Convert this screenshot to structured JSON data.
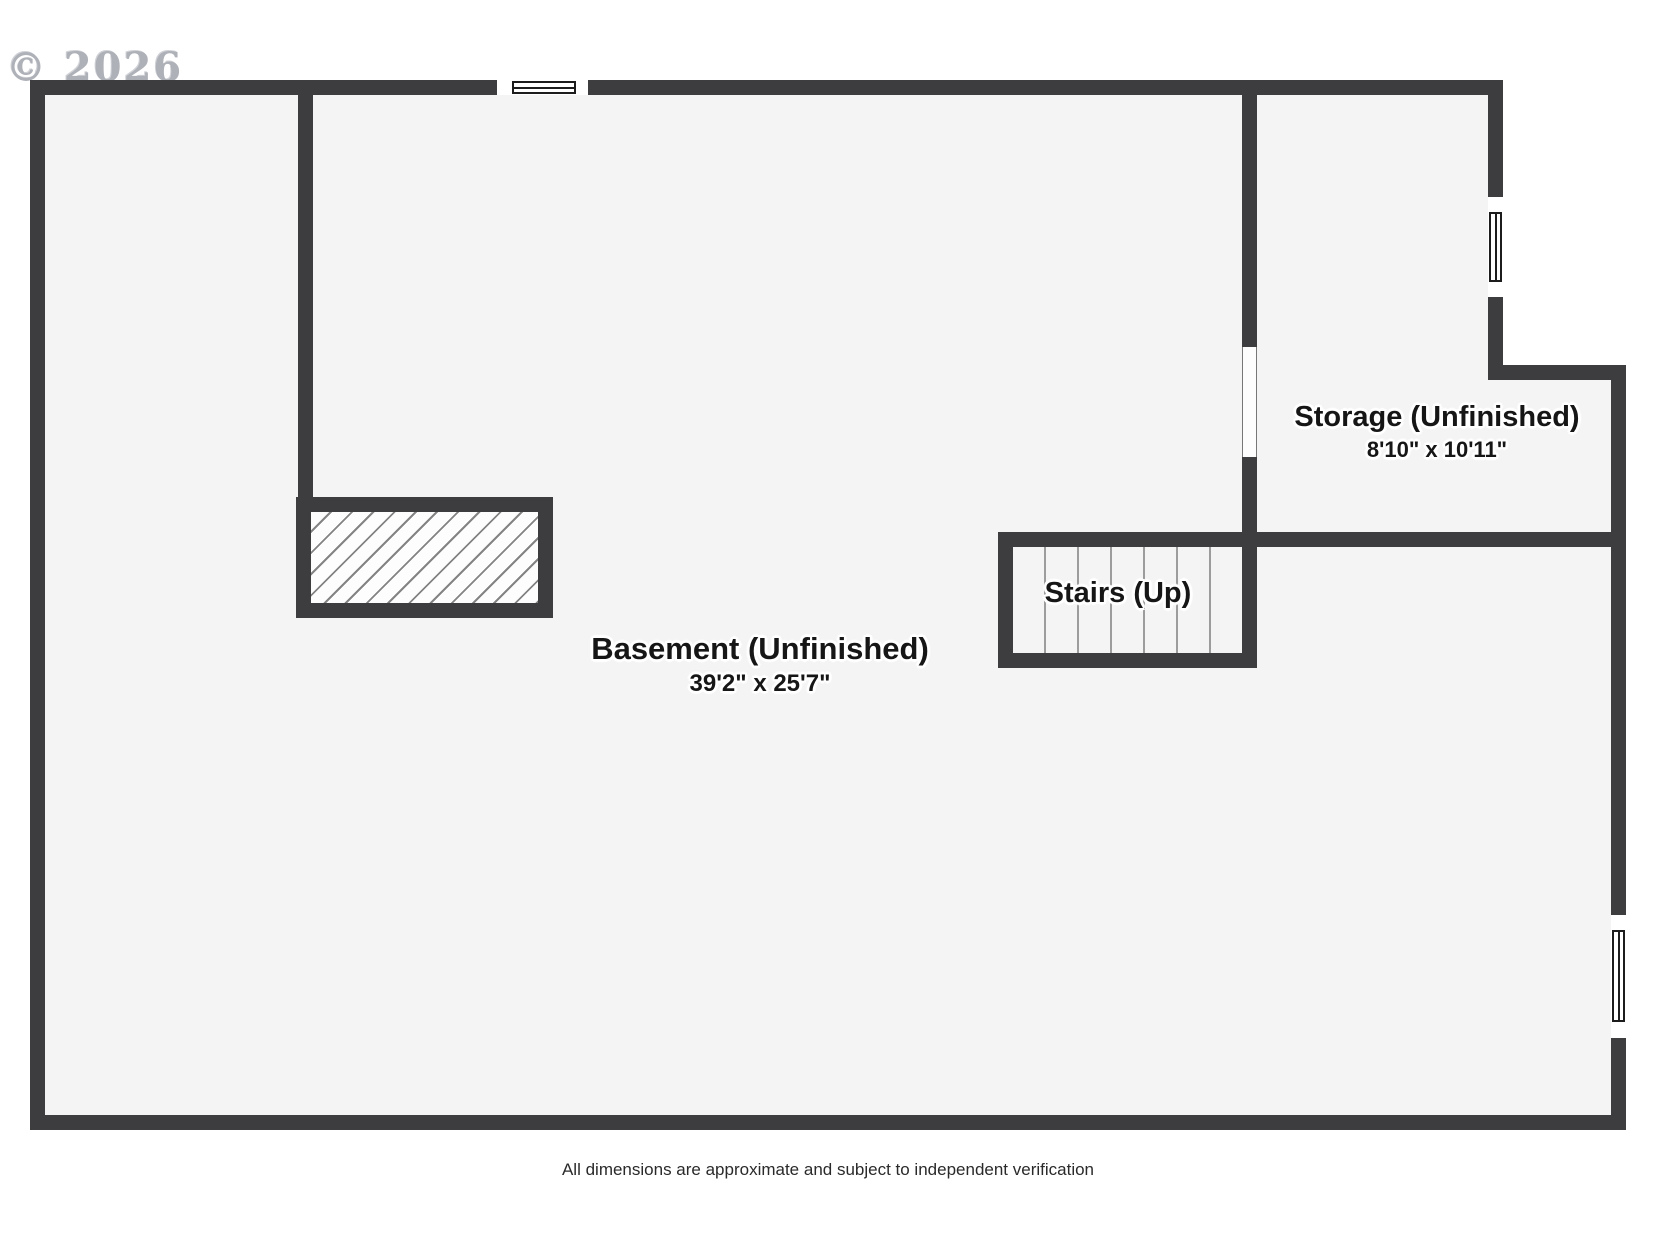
{
  "watermark": "© 2026",
  "rooms": {
    "basement": {
      "name": "Basement (Unfinished)",
      "dimensions": "39'2\" x 25'7\""
    },
    "storage": {
      "name": "Storage (Unfinished)",
      "dimensions": "8'10\" x 10'11\""
    },
    "stairs": {
      "name": "Stairs (Up)",
      "tread_count": 7
    }
  },
  "footer": {
    "disclaimer": "All dimensions are approximate and subject to independent verification"
  },
  "colors": {
    "wall": "#3d3d3f",
    "floor": "#f4f4f5",
    "hatch-line": "#848484",
    "tread-line": "#9c9c9c",
    "label-text": "#161616",
    "watermark-gray": "#aeb1b8"
  }
}
